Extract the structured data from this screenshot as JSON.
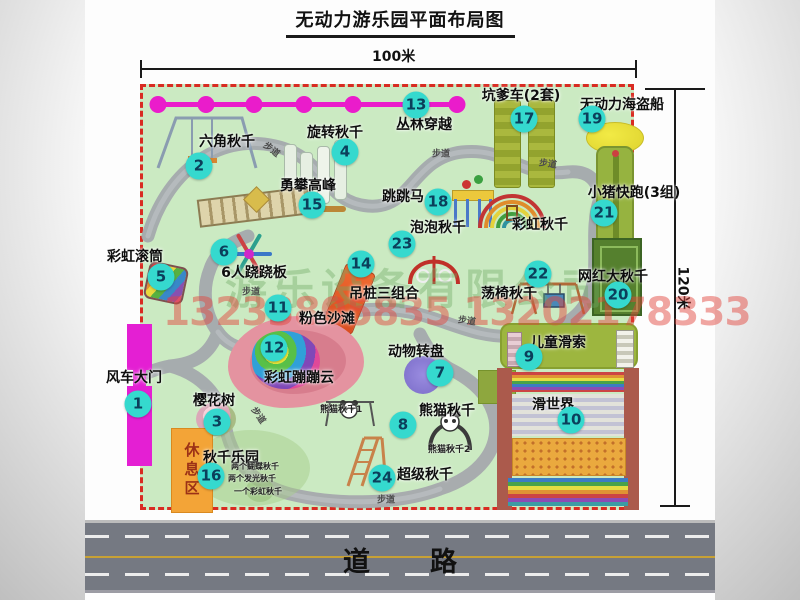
{
  "title": "无动力游乐园平面布局图",
  "dim_top": "100米",
  "dim_right": "120米",
  "road_label": "道路",
  "walkway": "步道",
  "rest_area": "休息区",
  "watermark": {
    "company": "游乐设备有限公司",
    "phone": "13233805835 13202178333"
  },
  "notes": {
    "panda1": "熊猫秋千1",
    "panda2": "熊猫秋千2",
    "swing_park": [
      "两个蝴蝶秋千",
      "两个发光秋千",
      "一个彩虹秋千"
    ]
  },
  "colors": {
    "park_green": "#cbeac2",
    "border_red": "#d92b22",
    "badge_cyan": "#35d9ce",
    "magenta": "#e41fd3",
    "road_gray": "#757982",
    "rest_orange": "#f3a437"
  },
  "attractions": [
    {
      "num": "1",
      "name": "风车大门",
      "lx": 134,
      "ly": 377,
      "bx": 138,
      "by": 404
    },
    {
      "num": "2",
      "name": "六角秋千",
      "lx": 227,
      "ly": 141,
      "bx": 199,
      "by": 166
    },
    {
      "num": "3",
      "name": "樱花树",
      "lx": 214,
      "ly": 400,
      "bx": 217,
      "by": 422
    },
    {
      "num": "4",
      "name": "旋转秋千",
      "lx": 335,
      "ly": 132,
      "bx": 345,
      "by": 152
    },
    {
      "num": "5",
      "name": "彩虹滚筒",
      "lx": 135,
      "ly": 256,
      "bx": 161,
      "by": 277
    },
    {
      "num": "6",
      "name": "6人跷跷板",
      "lx": 254,
      "ly": 272,
      "bx": 224,
      "by": 252
    },
    {
      "num": "7",
      "name": "动物转盘",
      "lx": 416,
      "ly": 351,
      "bx": 440,
      "by": 373
    },
    {
      "num": "8",
      "name": "熊猫秋千",
      "lx": 447,
      "ly": 410,
      "bx": 403,
      "by": 425
    },
    {
      "num": "9",
      "name": "儿童滑索",
      "lx": 558,
      "ly": 342,
      "bx": 529,
      "by": 357
    },
    {
      "num": "10",
      "name": "滑世界",
      "lx": 553,
      "ly": 404,
      "bx": 571,
      "by": 420
    },
    {
      "num": "11",
      "name": "粉色沙滩",
      "lx": 327,
      "ly": 318,
      "bx": 278,
      "by": 308
    },
    {
      "num": "12",
      "name": "彩虹蹦蹦云",
      "lx": 299,
      "ly": 377,
      "bx": 274,
      "by": 348
    },
    {
      "num": "13",
      "name": "丛林穿越",
      "lx": 424,
      "ly": 124,
      "bx": 416,
      "by": 105
    },
    {
      "num": "14",
      "name": "吊桩三组合",
      "lx": 384,
      "ly": 293,
      "bx": 361,
      "by": 264
    },
    {
      "num": "15",
      "name": "勇攀高峰",
      "lx": 308,
      "ly": 185,
      "bx": 312,
      "by": 205
    },
    {
      "num": "16",
      "name": "秋千乐园",
      "lx": 231,
      "ly": 457,
      "bx": 211,
      "by": 476
    },
    {
      "num": "17",
      "name": "坑爹车(2套)",
      "lx": 521,
      "ly": 95,
      "bx": 524,
      "by": 119
    },
    {
      "num": "18",
      "name": "跳跳马",
      "lx": 403,
      "ly": 196,
      "bx": 438,
      "by": 202
    },
    {
      "num": "19",
      "name": "无动力海盗船",
      "lx": 622,
      "ly": 104,
      "bx": 592,
      "by": 119
    },
    {
      "num": "20",
      "name": "网红大秋千",
      "lx": 613,
      "ly": 276,
      "bx": 618,
      "by": 295
    },
    {
      "num": "21",
      "name": "小猪快跑(3组)",
      "lx": 634,
      "ly": 192,
      "bx": 604,
      "by": 213
    },
    {
      "num": "22",
      "name": "荡椅秋千",
      "lx": 509,
      "ly": 293,
      "bx": 538,
      "by": 274
    },
    {
      "num": "23",
      "name": "泡泡秋千",
      "lx": 438,
      "ly": 227,
      "bx": 402,
      "by": 244
    },
    {
      "num": "24",
      "name": "超级秋千",
      "lx": 425,
      "ly": 474,
      "bx": 382,
      "by": 478
    },
    {
      "num": null,
      "name": "彩虹秋千",
      "lx": 540,
      "ly": 224,
      "bx": null,
      "by": null
    }
  ],
  "walkway_labels": [
    {
      "x": 272,
      "y": 149,
      "r": 38
    },
    {
      "x": 441,
      "y": 153,
      "r": 0
    },
    {
      "x": 548,
      "y": 163,
      "r": 8
    },
    {
      "x": 251,
      "y": 291,
      "r": 0
    },
    {
      "x": 467,
      "y": 320,
      "r": 8
    },
    {
      "x": 259,
      "y": 415,
      "r": 55
    },
    {
      "x": 386,
      "y": 499,
      "r": 0
    }
  ],
  "zipline_dots": [
    158,
    206,
    254,
    304,
    353,
    457
  ]
}
